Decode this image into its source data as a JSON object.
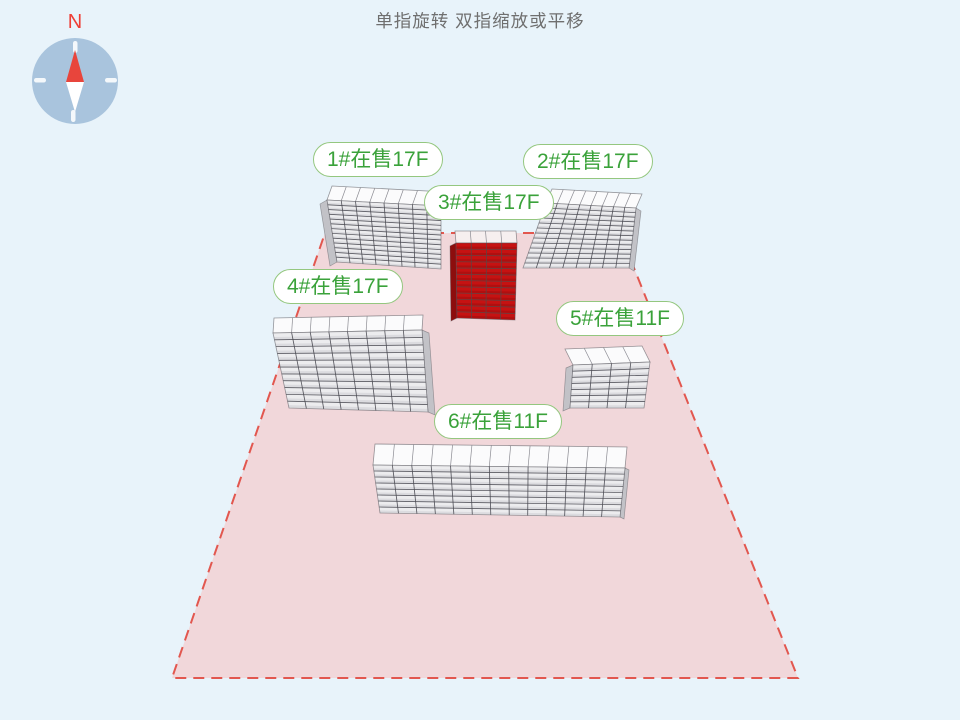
{
  "hint": "单指旋转 双指缩放或平移",
  "compass": {
    "north_label": "N"
  },
  "buildings": [
    {
      "label": "1#在售17F",
      "highlighted": false
    },
    {
      "label": "2#在售17F",
      "highlighted": false
    },
    {
      "label": "3#在售17F",
      "highlighted": true
    },
    {
      "label": "4#在售17F",
      "highlighted": false
    },
    {
      "label": "5#在售11F",
      "highlighted": false
    },
    {
      "label": "6#在售11F",
      "highlighted": false
    }
  ],
  "colors": {
    "background": "#e8f3fa",
    "ground_fill": "#f1d7da",
    "boundary": "#e2574f",
    "label_border": "#94c77f",
    "label_text": "#3aa23a",
    "building_face": "#ececee",
    "building_top": "#fbfbfc",
    "building_side": "#c2c2c7",
    "grid_line": "#4a4a52",
    "top_line": "#8b8b92",
    "outline": "#55555c",
    "highlight_face": "#c61212",
    "highlight_side": "#8d0d0d",
    "highlight_top": "#f6efef",
    "highlight_grid": "#5f4444",
    "compass_dial": "#a9c4dd",
    "compass_tick": "#f4f8fb",
    "compass_needle_north": "#e8453c",
    "compass_needle_south": "#ffffff",
    "north_text": "#ee3f36",
    "hint_text": "#6f6f6f"
  }
}
